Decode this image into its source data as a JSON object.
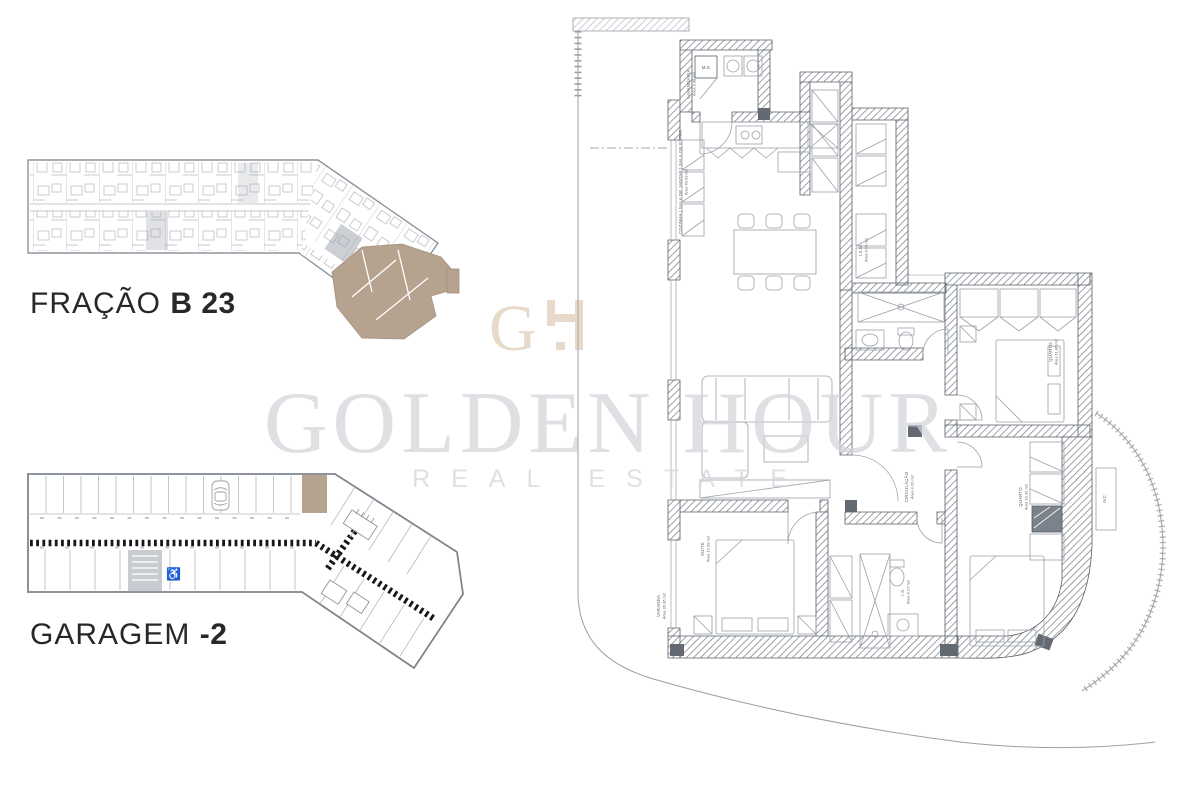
{
  "sheet": {
    "background": "#ffffff",
    "highlight_color": "#b5a28f",
    "line_color": "#9ba1a9",
    "wall_color": "#6e747d"
  },
  "watermark": {
    "monogram_g": "G",
    "title": "GOLDEN HOUR",
    "subtitle": "REAL ESTATE",
    "text_color": "#d2d5da",
    "monogram_color": "#c9ab88"
  },
  "plans": {
    "fraction": {
      "title_light": "FRAÇÃO",
      "title_bold": "B 23"
    },
    "garage": {
      "title_light": "GARAGEM",
      "title_bold": "-2",
      "accessible_icon": "♿"
    },
    "apartment": {
      "rooms": [
        {
          "id": "me",
          "name": "M.E",
          "area": ""
        },
        {
          "id": "lavandaria",
          "name": "LAVANDARIA",
          "area": "Área 3.38 m2"
        },
        {
          "id": "cozinha",
          "name": "COZINHA | SALA DE JANTAR | SALA DE ESTAR",
          "area": "Área 40.63 m2"
        },
        {
          "id": "ism",
          "name": "I.S.M.",
          "area": "Área 4.56 m2"
        },
        {
          "id": "quarto1",
          "name": "QUARTO",
          "area": "Área 11.86 m2"
        },
        {
          "id": "circulacao",
          "name": "CIRCULAÇÃO",
          "area": "Área 4.20 m2"
        },
        {
          "id": "quarto2",
          "name": "QUARTO",
          "area": "Área 10.42 m2"
        },
        {
          "id": "ac",
          "name": "A/C",
          "area": ""
        },
        {
          "id": "suite",
          "name": "SUITE",
          "area": "Área 12.99 m2"
        },
        {
          "id": "is",
          "name": "I.S.",
          "area": "Área 4.17 m2"
        },
        {
          "id": "varanda",
          "name": "VARANDA",
          "area": "Área 36.36 m2"
        }
      ]
    }
  }
}
